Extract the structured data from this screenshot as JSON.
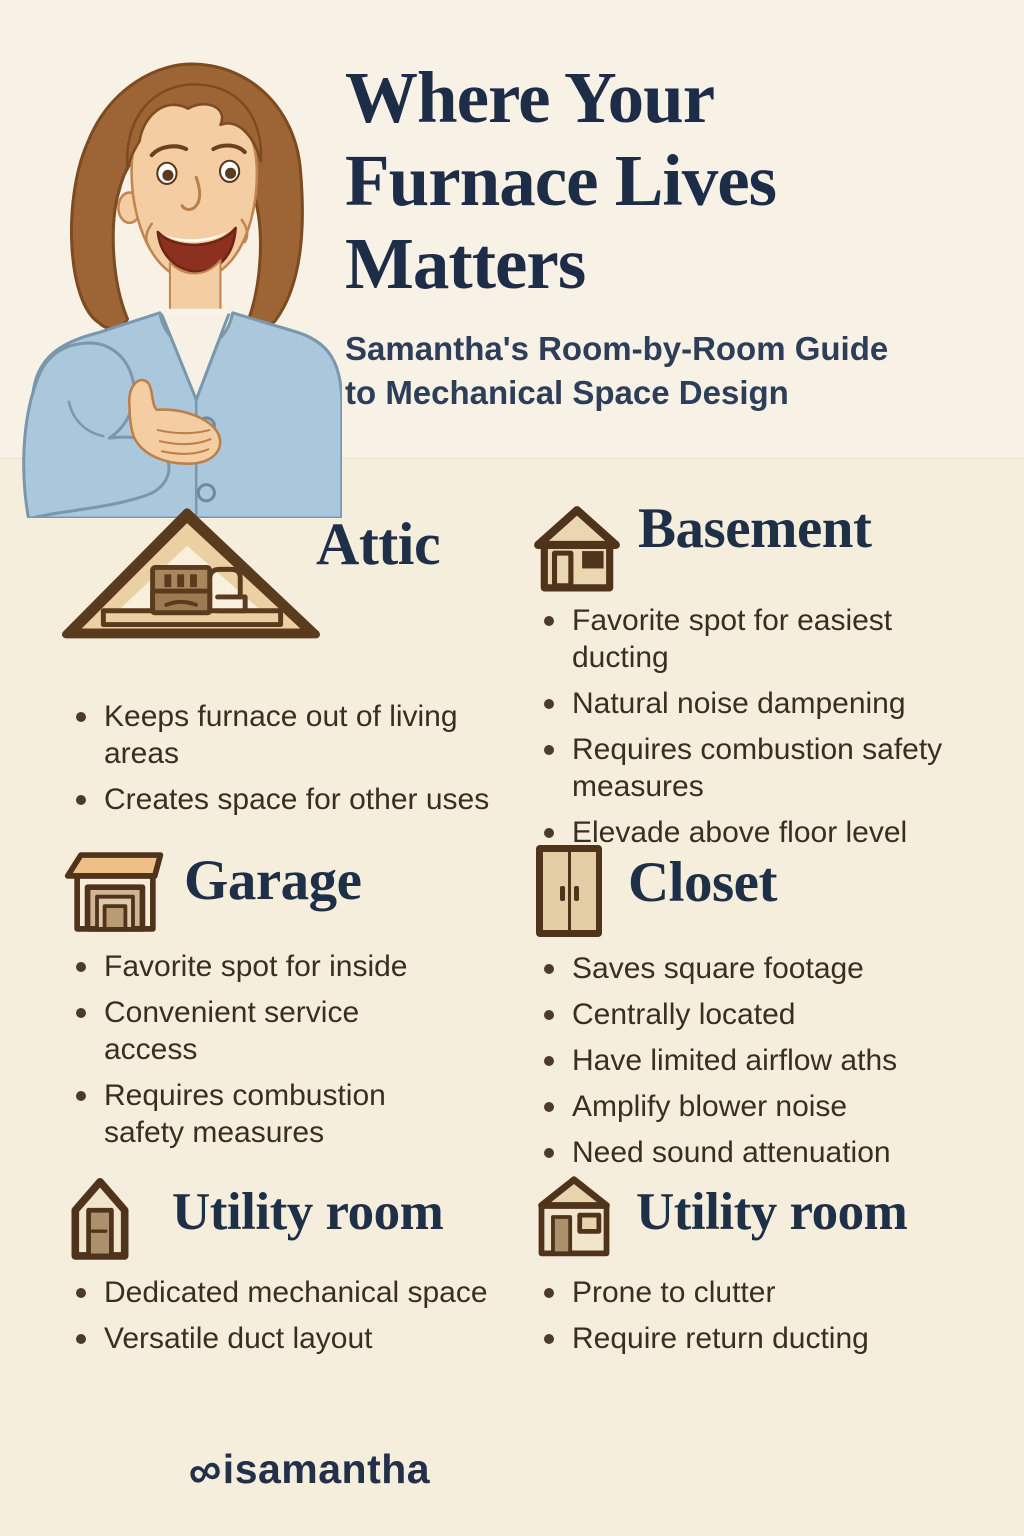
{
  "page": {
    "title": "Where Your Furnace Lives Matters",
    "title_lines": [
      "Where Your",
      "Furnace Lives",
      "Matters"
    ],
    "subtitle": "Samantha's Room-by-Room Guide to Mechanical Space Design",
    "subtitle_lines": [
      "Samantha's Room-by-Room Guide",
      "to Mechanical Space Design"
    ]
  },
  "illustration": {
    "name": "samantha-presenter-illustration",
    "description": "smiling woman with brown shoulder-length hair wearing a light blue cardigan over a white top, gesturing with an open hand"
  },
  "sections": [
    {
      "id": "attic",
      "heading": "Attic",
      "icon": "attic-cutaway-house-icon",
      "bullets": [
        "Keeps furnace out of living areas",
        "Creates space for other uses"
      ]
    },
    {
      "id": "basement",
      "heading": "Basement",
      "icon": "house-door-window-icon",
      "bullets": [
        "Favorite spot for easiest ducting",
        "Natural noise dampening",
        "Requires combustion safety measures",
        "Elevade above floor level"
      ]
    },
    {
      "id": "garage",
      "heading": "Garage",
      "icon": "garage-icon",
      "bullets": [
        "Favorite spot for inside",
        "Convenient service access",
        "Requires combustion safety measures"
      ]
    },
    {
      "id": "closet",
      "heading": "Closet",
      "icon": "closet-double-doors-icon",
      "bullets": [
        "Saves square footage",
        "Centrally located",
        "Have limited airflow aths",
        "Amplify blower noise",
        "Need sound attenuation"
      ]
    },
    {
      "id": "utility-room-left",
      "heading": "Utility room",
      "icon": "narrow-house-door-icon",
      "bullets": [
        "Dedicated mechanical space",
        "Versatile duct layout"
      ]
    },
    {
      "id": "utility-room-right",
      "heading": "Utility room",
      "icon": "house-door-window-icon",
      "bullets": [
        "Prone to clutter",
        "Require return ducting"
      ]
    }
  ],
  "footer": {
    "logo_icon": "infinity-loop-icon",
    "logo_mark": "∞",
    "brand": "isamantha"
  },
  "colors": {
    "background_top": "#f8f1e6",
    "background_bottom": "#f6eedd",
    "heading_navy": "#1e3048",
    "body_text": "#3a2e22",
    "bullet_dot": "#4c3b29",
    "icon_outline": "#54371d",
    "icon_fill": "#ead7b2",
    "roof_orange": "#eec085",
    "cardigan_blue": "#abc7db",
    "skin": "#f4cda2",
    "hair_brown": "#9d6535"
  }
}
